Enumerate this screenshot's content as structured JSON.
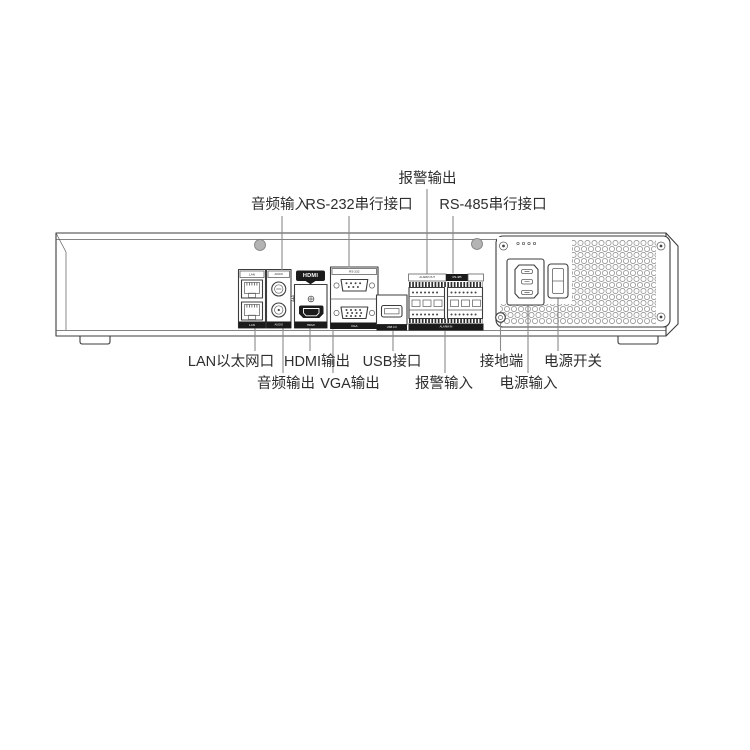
{
  "labels": {
    "top": {
      "alarm_out": "报警输出",
      "audio_in": "音频输入",
      "rs232": "RS-232串行接口",
      "rs485": "RS-485串行接口"
    },
    "bottom_row1": {
      "lan": "LAN以太网口",
      "hdmi": "HDMI输出",
      "usb": "USB接口",
      "ground": "接地端",
      "power_switch": "电源开关"
    },
    "bottom_row2": {
      "audio_out": "音频输出",
      "vga": "VGA输出",
      "alarm_in": "报警输入",
      "power_in": "电源输入"
    }
  },
  "port_strips": {
    "lan_top": "LAN",
    "lan_bottom": "LAN",
    "audio_top": "AUDIO",
    "audio_bottom": "AUDIO",
    "hdmi_badge": "HDMI",
    "hdmi_bottom": "HDMI",
    "rs232_top": "RS-232",
    "vga_bottom": "VGA",
    "usb_bottom": "USB 3.0",
    "alarm_out": "ALARM OUT",
    "rs485": "RS-485",
    "alarm_in": "ALARM IN"
  },
  "colors": {
    "line": "#3c3c3c",
    "leader": "#8a8a8a",
    "strip_dark": "#1b1b1b",
    "label_text": "#2e2e2e",
    "vent_hole": "#9a9a9a",
    "screw_fill": "#b3b3b3"
  }
}
